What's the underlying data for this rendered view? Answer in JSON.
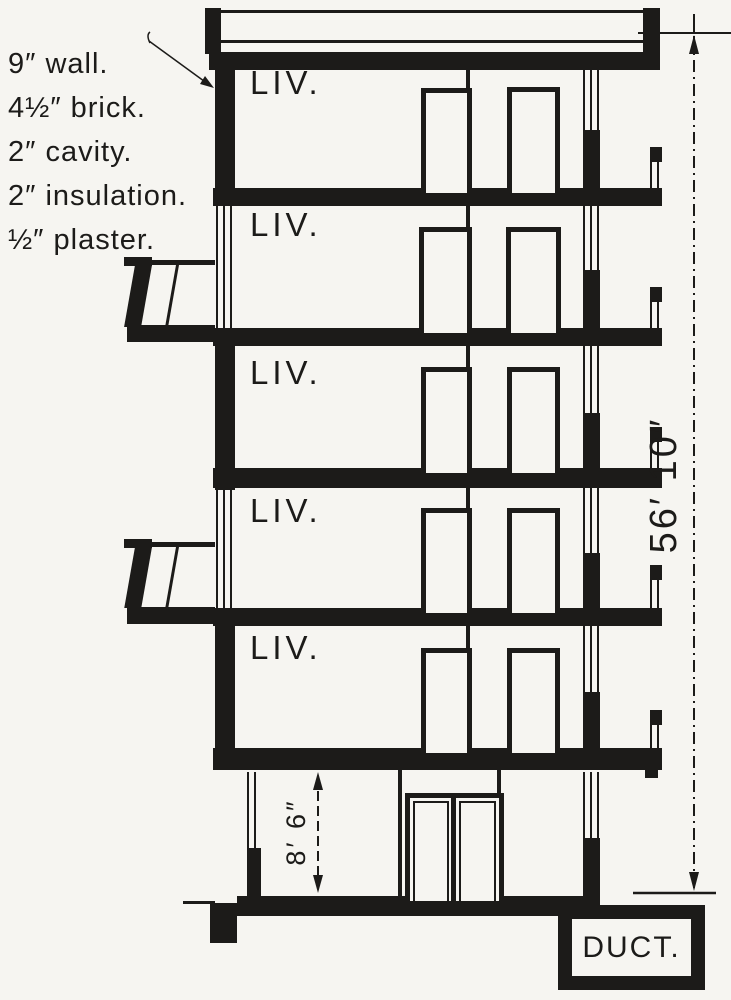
{
  "colors": {
    "ink": "#1c1b19",
    "paper": "#f6f5f1"
  },
  "annotation": {
    "lines": [
      "9″ wall.",
      "4½″ brick.",
      "2″ cavity.",
      "2″ insulation.",
      "½″ plaster."
    ]
  },
  "floors": [
    {
      "label": "LIV."
    },
    {
      "label": "LIV."
    },
    {
      "label": "LIV."
    },
    {
      "label": "LIV."
    },
    {
      "label": "LIV."
    }
  ],
  "dimensions": {
    "overall_height": "56′ 10″",
    "ground_floor_height": "8′ 6″"
  },
  "duct": {
    "label": "DUCT."
  }
}
